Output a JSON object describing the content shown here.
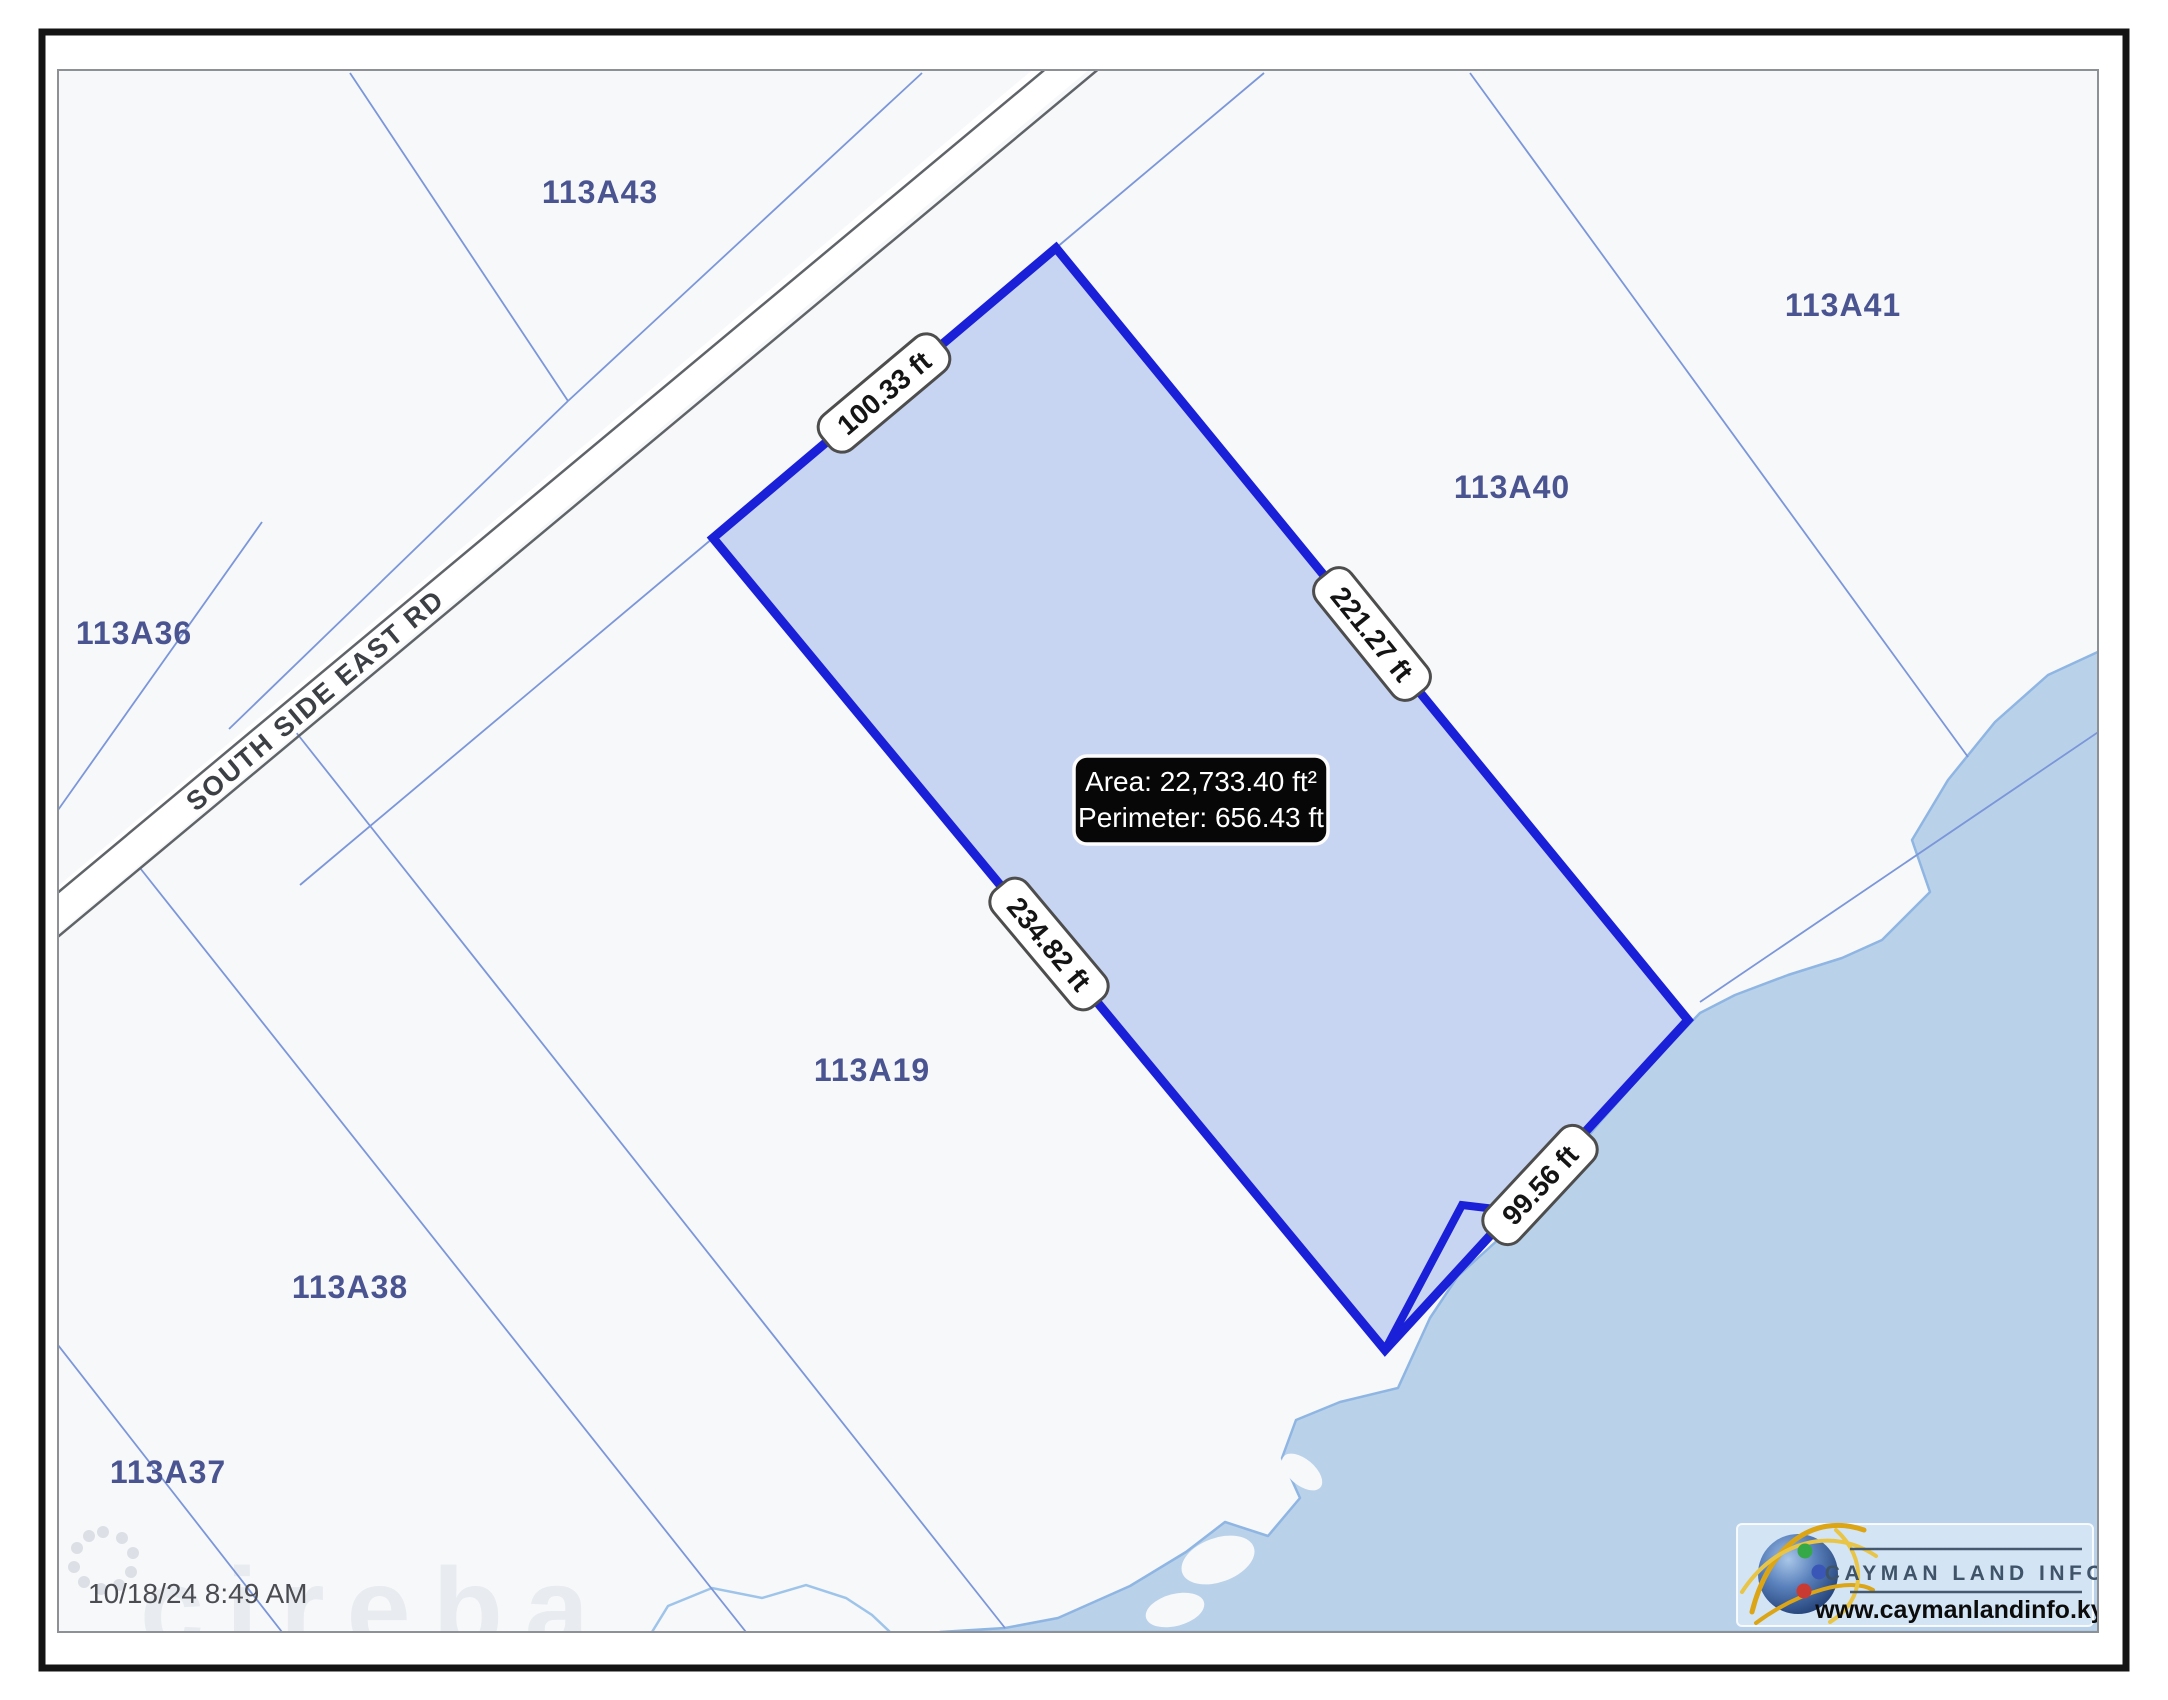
{
  "map": {
    "road_label": "SOUTH SIDE EAST RD",
    "parcel_labels": {
      "a43": "113A43",
      "a41": "113A41",
      "a40": "113A40",
      "a36": "113A36",
      "a19": "113A19",
      "a38": "113A38",
      "a37": "113A37"
    },
    "highlighted_parcel": {
      "info": {
        "area": "Area: 22,733.40 ft²",
        "perimeter": "Perimeter: 656.43 ft"
      },
      "measurements": {
        "north": "100.33 ft",
        "east": "221.27 ft",
        "south": "234.82 ft",
        "southeast": "99.56 ft"
      }
    }
  },
  "footer": {
    "timestamp": "10/18/24 8:49 AM",
    "watermark": "cireba"
  },
  "logo": {
    "title": "CAYMAN LAND INFO",
    "website": "www.caymanlandinfo.ky"
  },
  "colors": {
    "parcel_outline": "#1a20d8",
    "parcel_fill": "#c8d5f2",
    "water": "#b9d2ea",
    "coastline": "#8fb5e3",
    "boundary_line": "#7b96d9",
    "parcel_label": "#4a5490",
    "info_box_bg": "#070707"
  }
}
